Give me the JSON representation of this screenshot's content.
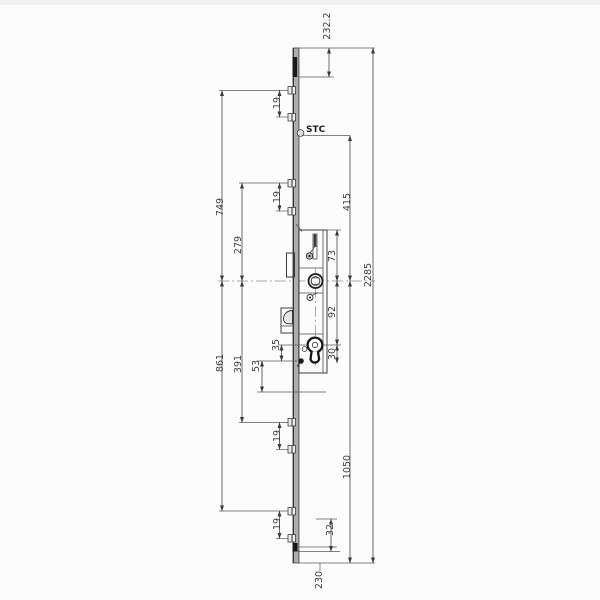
{
  "drawing": {
    "kind": "technical-dimension-drawing",
    "subject": "multipoint-door-lock-faceplate",
    "colors": {
      "background": "#fcfcfc",
      "line": "#454545",
      "bold_outline": "#161616",
      "plate_fill": "#adadad",
      "bolt_fill": "#1a1a1a"
    },
    "dims": {
      "stc": "STC",
      "d232_2": "232.2",
      "d2285": "2285",
      "d415": "415",
      "d1050": "1050",
      "d230": "230",
      "d749": "749",
      "d279": "279",
      "d861": "861",
      "d391": "391",
      "d73": "73",
      "d92": "92",
      "d35": "35",
      "d53": "53",
      "d30": "30",
      "d32": "32",
      "d19a": "19",
      "d19b": "19",
      "d19c": "19",
      "d19d": "19"
    }
  }
}
